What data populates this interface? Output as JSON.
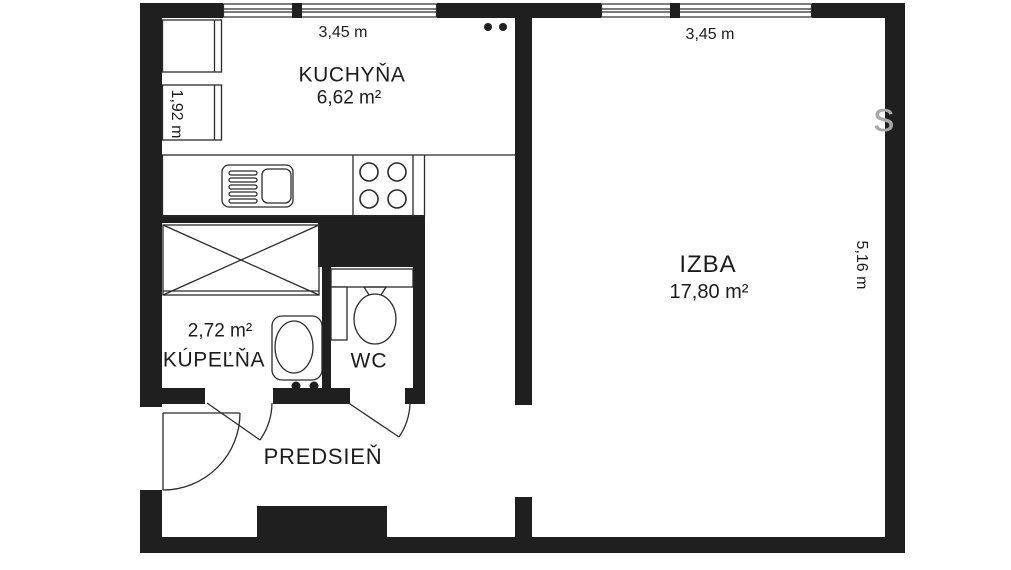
{
  "plan": {
    "rooms": [
      {
        "id": "kuchyna",
        "name": "KUCHYŇA",
        "area": "6,62 m²"
      },
      {
        "id": "izba",
        "name": "IZBA",
        "area": "17,80 m²"
      },
      {
        "id": "kupelna",
        "name": "KÚPEĽŇA",
        "area": "2,72 m²"
      },
      {
        "id": "wc",
        "name": "WC"
      },
      {
        "id": "predsien",
        "name": "PREDSIEŇ"
      }
    ],
    "dimensions": {
      "kitchen_width": "3,45 m",
      "kitchen_depth": "1,92 m",
      "living_width": "3,45 m",
      "living_depth": "5,16 m"
    },
    "watermark": "s",
    "colors": {
      "wall": "#1f1f1f",
      "line": "#2b2b2b",
      "text": "#1c1c1c",
      "background": "#ffffff",
      "watermark": "#a8a8a8"
    }
  }
}
